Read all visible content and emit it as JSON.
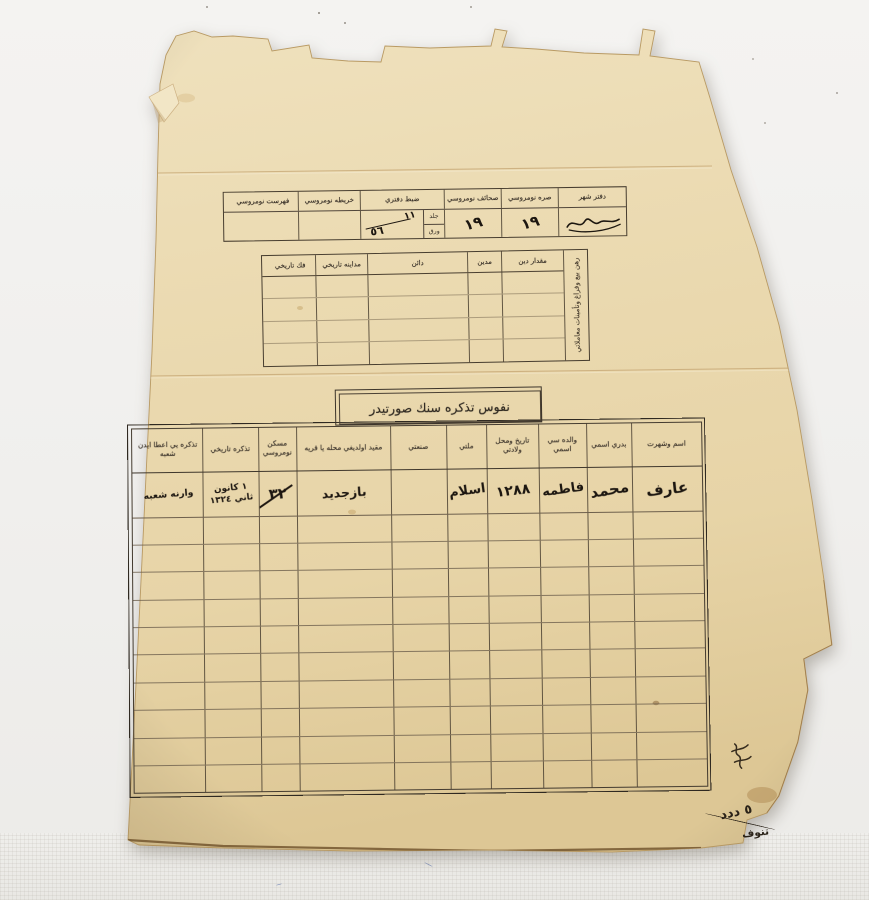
{
  "photo": {
    "background_color": "#f0efed",
    "paper_color": "#e9d9af",
    "line_color": "#473d2f",
    "ink_color": "#1c1610"
  },
  "top_table": {
    "columns": [
      {
        "label": "دفتر شهر",
        "value": ""
      },
      {
        "label": "صره نومروسي",
        "value": "١٩"
      },
      {
        "label": "صحائف نومروسي",
        "value": "١٩"
      },
      {
        "label": "ضبط دفتري",
        "jild_label": "جلد",
        "varak_label": "ورق",
        "value_top": "١١",
        "value_bottom": "٥٦"
      },
      {
        "label": "خريطه نومروسي",
        "value": ""
      },
      {
        "label": "فهرست نومروسي",
        "value": ""
      }
    ]
  },
  "debt_table": {
    "side_label": "رهن بيع وفراغ وتأمينات معاملاتي",
    "headers": [
      "مقدار دين",
      "مدين",
      "دائن",
      "مداينه تاريخي",
      "فك تاريخي"
    ],
    "empty_rows": 4
  },
  "main_table": {
    "title": "نفوس تذكره سنك صورتيدر",
    "headers": [
      "اسم وشهرت",
      "بدري اسمي",
      "والده سي اسمي",
      "تاريخ ومحل ولادتي",
      "ملتي",
      "صنعتي",
      "مقيد اولديغي محله يا قريه",
      "مسكن نومروسي",
      "تذكره تاريخي",
      "تذكره يي اعطا ايدن شعبه"
    ],
    "entry": {
      "name": "عارف",
      "father": "محمد",
      "mother": "فاطمه",
      "birth": "١٢٨٨",
      "religion": "اسلام",
      "craft": "",
      "place": "بازجديد",
      "house_no": "٣٢",
      "date": "١ كانون ثاني ١٣٢٤",
      "branch": "وارنه شعبه"
    },
    "empty_rows": 10
  },
  "notes": {
    "corner_note_1": "٥ ددد",
    "corner_note_2": "تنوف"
  }
}
